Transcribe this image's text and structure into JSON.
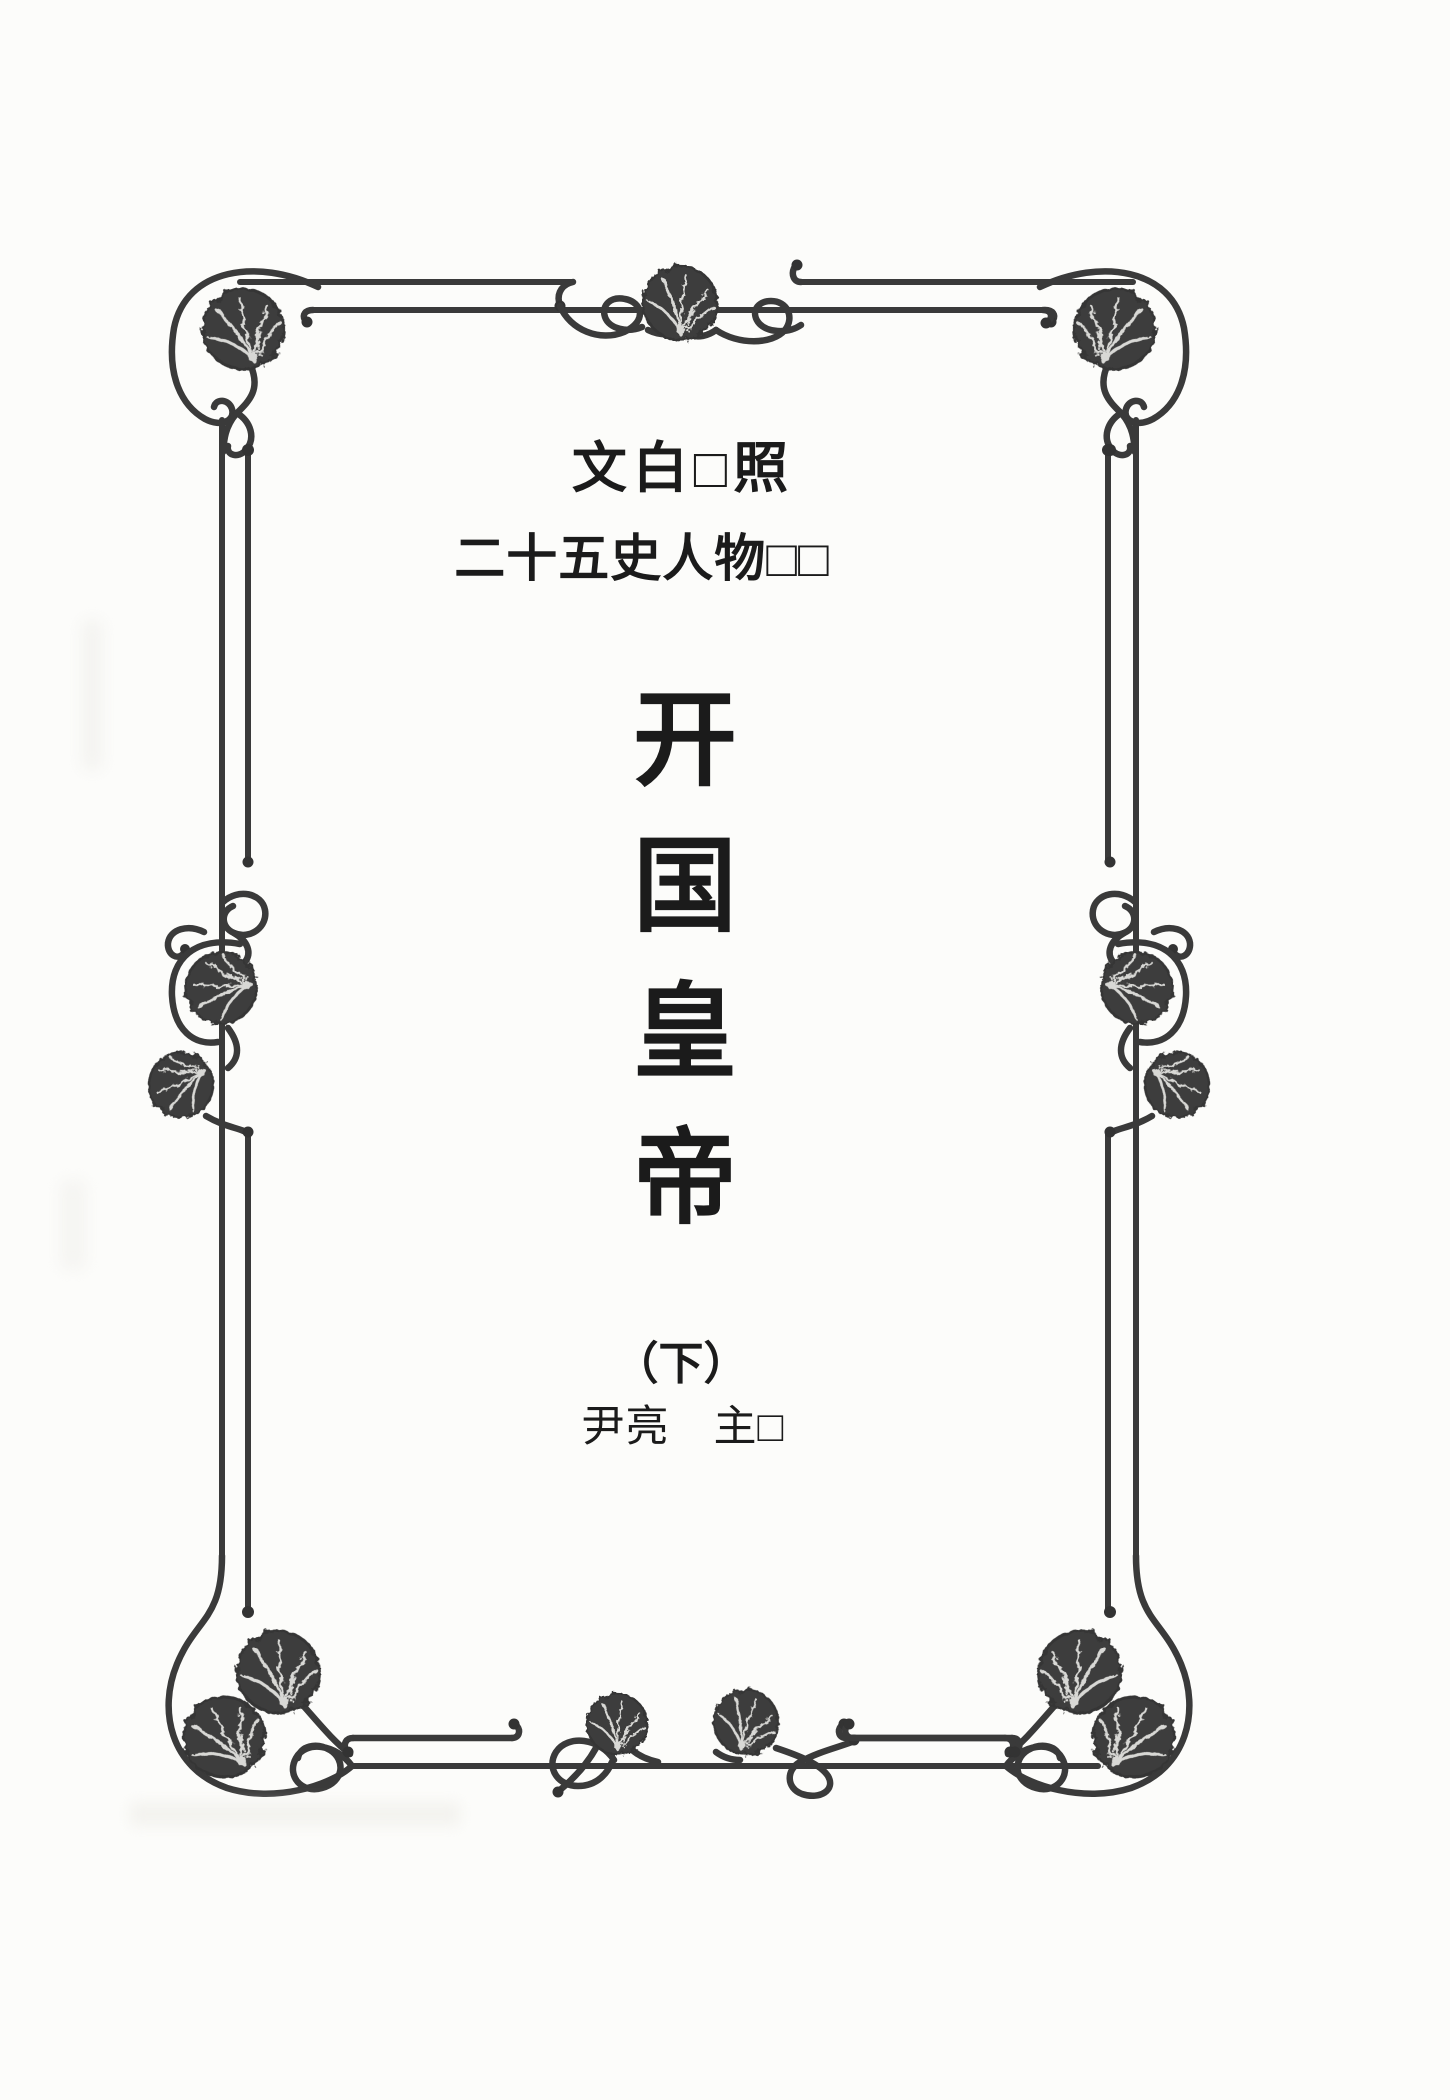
{
  "title_page": {
    "series_line_1": "文白□照",
    "series_line_2": "二十五史人物□□",
    "main_title": "开国皇帝",
    "volume_label": "（下）",
    "byline": "尹亮　主□"
  },
  "decorations": {
    "border_style": "art-nouveau double-rule frame",
    "ornaments": [
      "gingko-leaf",
      "spiral-flourish",
      "figure-eight-swirl",
      "curl-capped-rules"
    ]
  },
  "colors": {
    "ink": "#1b1b1b",
    "border_ink": "#3a3a3a",
    "leaf_fill": "#3e3e3e",
    "paper": "#fcfcfa"
  }
}
